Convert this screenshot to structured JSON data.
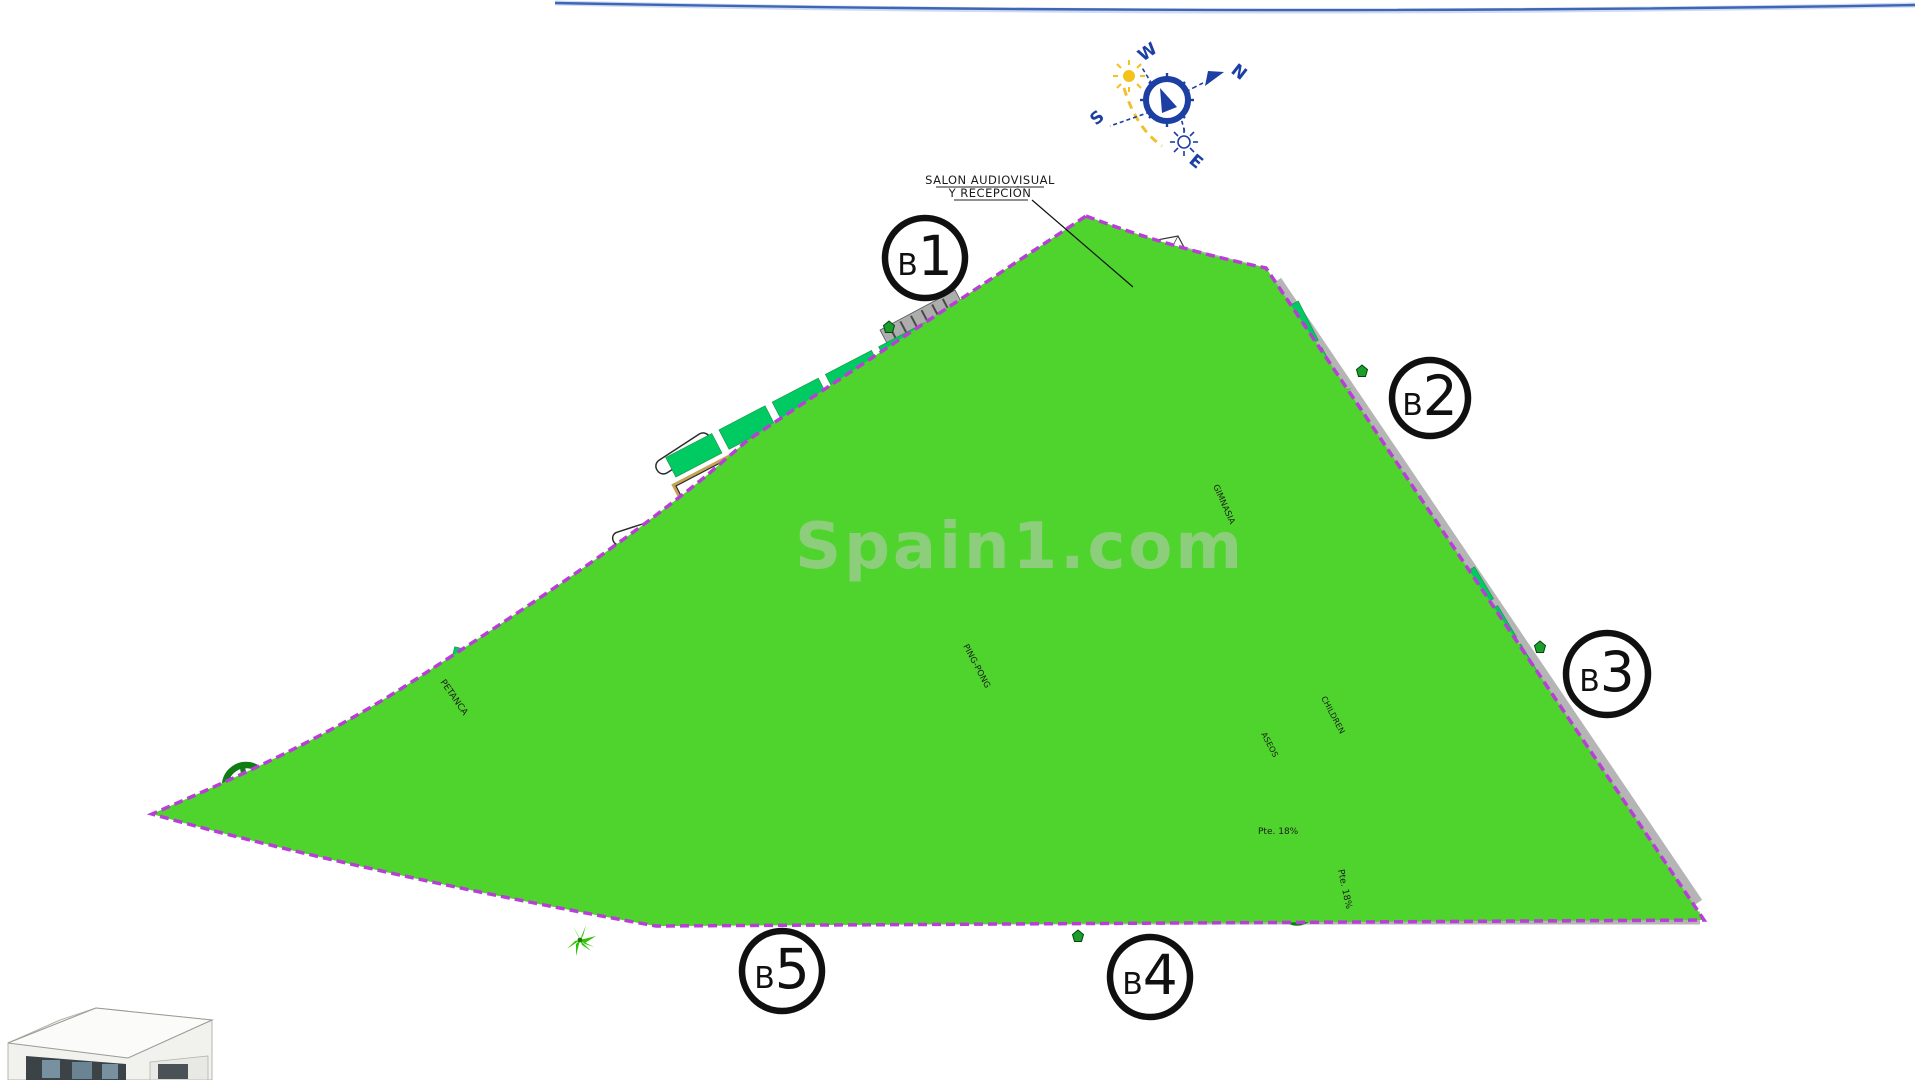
{
  "watermark": "Spain1.com",
  "compass": {
    "north": "N",
    "south": "S",
    "east": "E",
    "west": "W"
  },
  "annotation": {
    "line1": "SALON AUDIOVISUAL",
    "line2": "Y RECEPCIÓN"
  },
  "area_labels": {
    "petanca": "PETANCA",
    "ping_pong": "PING-PONG",
    "gimnasia": "GIMNASIA",
    "children": "CHILDREN",
    "aseos": "ASEOS"
  },
  "ramp_labels": {
    "ramp1": "Pte. 18%",
    "ramp2": "Pte. 18%"
  },
  "colors": {
    "lawn": "#4FD42D",
    "garden_patch": "#00CB63",
    "boundary": "#B83FD6",
    "unit_number": "#4145C4",
    "pool_water": "#8F8FE0",
    "pool_deck": "#E9CD84",
    "compass_blue": "#1C3FA4",
    "sun_yellow": "#F5C21C",
    "tree_green": "#0F7C14",
    "path_gray": "#B5B5B5"
  },
  "buildings": [
    {
      "id": "B1",
      "label": "B1",
      "units": [
        "01",
        "02",
        "03",
        "04",
        "05",
        "06",
        "07",
        "08",
        "09",
        "10",
        "11",
        "12",
        "13",
        "14",
        "15",
        "16",
        "17",
        "18",
        "19",
        "20",
        "21"
      ]
    },
    {
      "id": "B2",
      "label": "B2",
      "units": [
        "22",
        "23",
        "24",
        "25",
        "26",
        "27",
        "28",
        "29",
        "30",
        "31",
        "32",
        "33",
        "34",
        "35",
        "36",
        "37",
        "38",
        "39",
        "40",
        "41",
        "42"
      ]
    },
    {
      "id": "B3",
      "label": "B3",
      "units": [
        "43",
        "44",
        "45",
        "46",
        "47",
        "48",
        "49",
        "50",
        "51",
        "52",
        "53",
        "54",
        "55",
        "56",
        "57",
        "58",
        "59",
        "60",
        "61",
        "62",
        "63"
      ]
    },
    {
      "id": "B4",
      "label": "B4",
      "units": [
        "84",
        "83",
        "82",
        "81",
        "80",
        "79",
        "78",
        "77",
        "76",
        "75",
        "74",
        "73",
        "72",
        "71",
        "70",
        "69",
        "68",
        "67",
        "66",
        "65",
        "64"
      ]
    },
    {
      "id": "B5",
      "label": "B5",
      "units": [
        "108",
        "107",
        "106",
        "105",
        "104",
        "103",
        "102",
        "101",
        "100",
        "99",
        "98",
        "97",
        "96",
        "95",
        "94",
        "93",
        "92",
        "91",
        "90",
        "89",
        "88",
        "87",
        "86",
        "85"
      ]
    }
  ]
}
